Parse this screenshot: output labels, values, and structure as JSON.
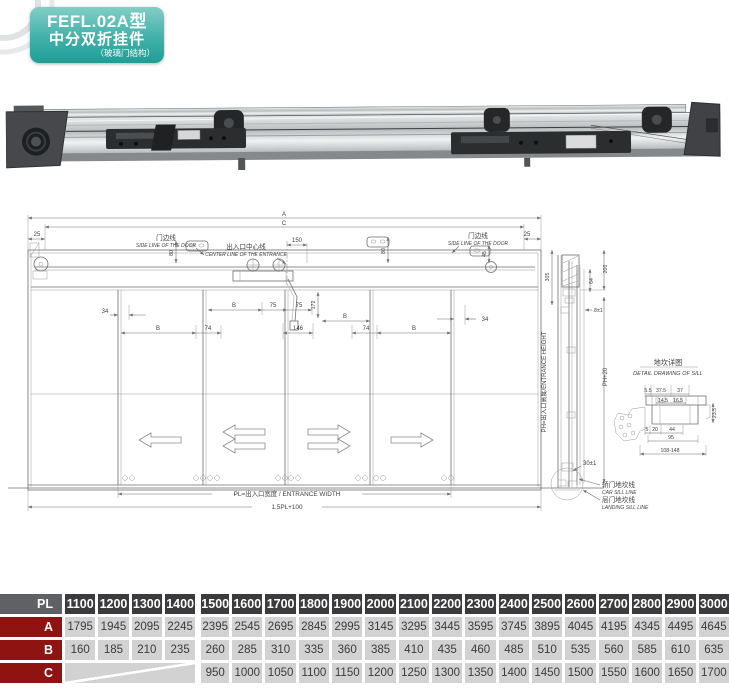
{
  "badge": {
    "model": "FEFL.02A型",
    "product": "中分双折挂件",
    "subtitle": "（玻璃门结构）"
  },
  "drawing": {
    "labels": {
      "a": "A",
      "c": "C",
      "n25": "25",
      "n45": "45",
      "n80": "80",
      "n150": "150",
      "side_cn": "门边线",
      "side_en": "SIDE LINE OF THE DOOR",
      "center_cn": "出入口中心线",
      "center_en": "CENTER LINE OF THE ENTRANCE",
      "n34": "34",
      "b": "B",
      "n74": "74",
      "n75": "75",
      "n172": "172",
      "n146": "146",
      "pl": "PL=出入口宽度 / ENTRANCE WIDTH",
      "overall": "1.5PL+100",
      "n305": "305",
      "n200": "200",
      "n64": "64",
      "n8": "8±1",
      "ph": "PH=出入口高度/ENTRANCE HEIGHT",
      "ph20": "PH+20",
      "n30": "30±1",
      "car_cn": "轿门地坎线",
      "car_en": "CAR SILL LINE",
      "land_cn": "层门地坎线",
      "land_en": "LANDING SILL LINE",
      "sill_cn": "地坎详图",
      "sill_en": "DETAIL DRAWING OF SILL",
      "s55": "5.5",
      "s375": "37.5",
      "s37": "37",
      "s145": "14.5",
      "s165": "16.5",
      "s235": "23.5",
      "s5": "5",
      "s20": "20",
      "s44": "44",
      "s95": "95",
      "s108": "108-148"
    }
  },
  "table": {
    "corner": "PL",
    "columns": [
      "1100",
      "1200",
      "1300",
      "1400",
      "1500",
      "1600",
      "1700",
      "1800",
      "1900",
      "2000",
      "2100",
      "2200",
      "2300",
      "2400",
      "2500",
      "2600",
      "2700",
      "2800",
      "2900",
      "3000"
    ],
    "rows": [
      {
        "label": "A",
        "values": [
          "1795",
          "1945",
          "2095",
          "2245",
          "2395",
          "2545",
          "2695",
          "2845",
          "2995",
          "3145",
          "3295",
          "3445",
          "3595",
          "3745",
          "3895",
          "4045",
          "4195",
          "4345",
          "4495",
          "4645"
        ]
      },
      {
        "label": "B",
        "values": [
          "160",
          "185",
          "210",
          "235",
          "260",
          "285",
          "310",
          "335",
          "360",
          "385",
          "410",
          "435",
          "460",
          "485",
          "510",
          "535",
          "560",
          "585",
          "610",
          "635"
        ]
      },
      {
        "label": "C",
        "values": [
          null,
          null,
          null,
          null,
          "950",
          "1000",
          "1050",
          "1100",
          "1150",
          "1200",
          "1250",
          "1300",
          "1350",
          "1400",
          "1450",
          "1500",
          "1550",
          "1600",
          "1650",
          "1700"
        ]
      }
    ]
  },
  "colors": {
    "badge_top": "#82cec7",
    "badge_bottom": "#1f9e96",
    "table_header": "#3b3b3d",
    "table_corner": "#606164",
    "table_row_label": "#8e1311",
    "table_cell": "#d2d2d3"
  }
}
